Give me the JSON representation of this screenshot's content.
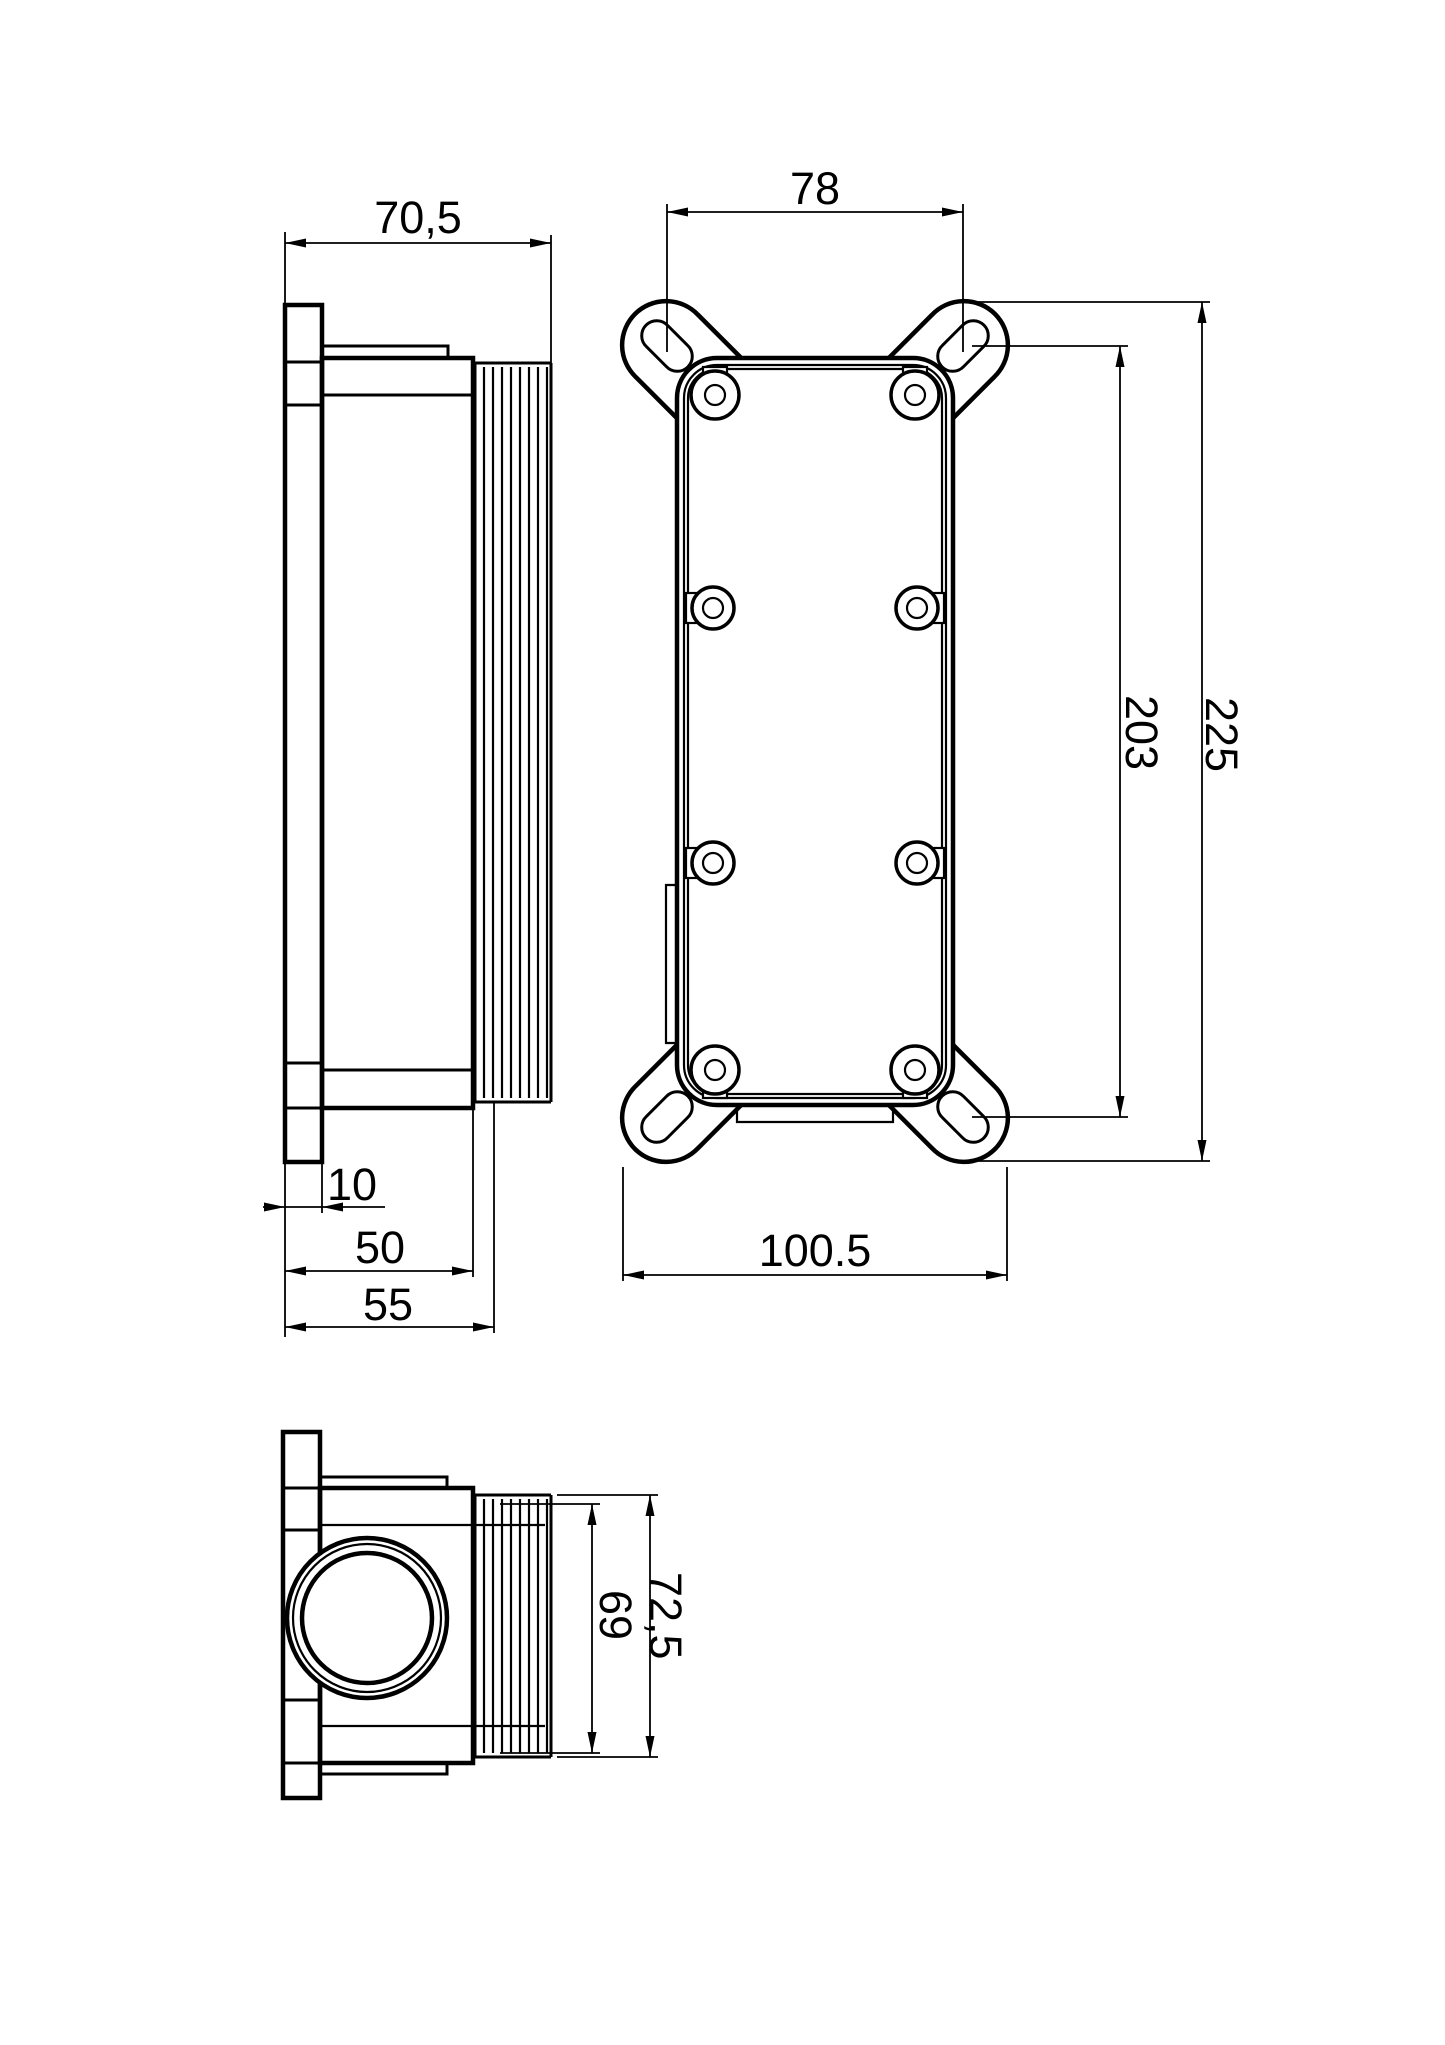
{
  "colors": {
    "background": "#ffffff",
    "line": "#000000"
  },
  "views": {
    "side": {
      "dims": {
        "width": "70,5",
        "flange_thickness": "10",
        "body_depth": "50",
        "overall_depth": "55"
      }
    },
    "front": {
      "dims": {
        "slot_spacing_width": "78",
        "slot_spacing_height": "203",
        "overall_height": "225",
        "overall_width": "100.5"
      }
    },
    "end": {
      "dims": {
        "body_height": "69",
        "overall_height": "72,5"
      }
    }
  }
}
